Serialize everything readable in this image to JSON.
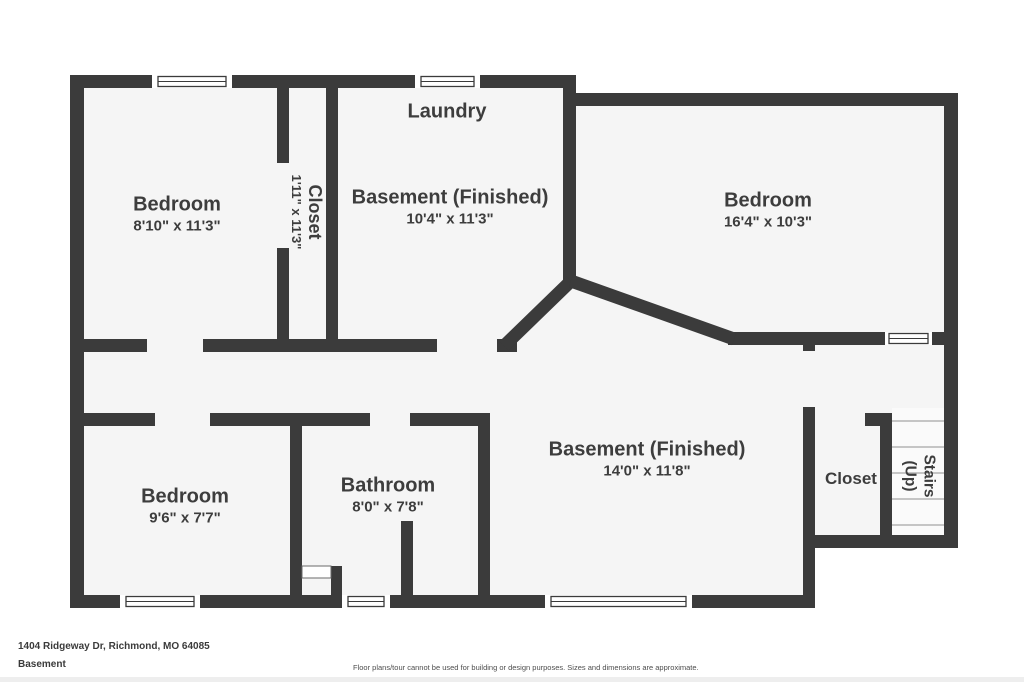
{
  "colors": {
    "wall": "#3b3b3b",
    "floor": "#f5f5f5",
    "text": "#3d3d3d",
    "stair_tread": "#c5c5c5",
    "background": "#ffffff"
  },
  "rooms": {
    "bedroom_top_left": {
      "label": "Bedroom",
      "dims": "8'10\" x 11'3\""
    },
    "closet_top": {
      "label": "Closet",
      "dims": "1'11\" x 11'3\""
    },
    "laundry": {
      "label": "Laundry"
    },
    "basement_top": {
      "label": "Basement (Finished)",
      "dims": "10'4\" x 11'3\""
    },
    "bedroom_top_right": {
      "label": "Bedroom",
      "dims": "16'4\" x 10'3\""
    },
    "bedroom_bottom_left": {
      "label": "Bedroom",
      "dims": "9'6\" x 7'7\""
    },
    "bathroom": {
      "label": "Bathroom",
      "dims": "8'0\" x 7'8\""
    },
    "basement_bottom": {
      "label": "Basement (Finished)",
      "dims": "14'0\" x 11'8\""
    },
    "closet_bottom_right": {
      "label": "Closet"
    },
    "stairs": {
      "label": "Stairs",
      "sublabel": "(Up)"
    }
  },
  "footer": {
    "address": "1404 Ridgeway Dr, Richmond, MO 64085",
    "level": "Basement",
    "disclaimer": "Floor plans/tour cannot be used for building or design purposes. Sizes and dimensions are approximate."
  }
}
